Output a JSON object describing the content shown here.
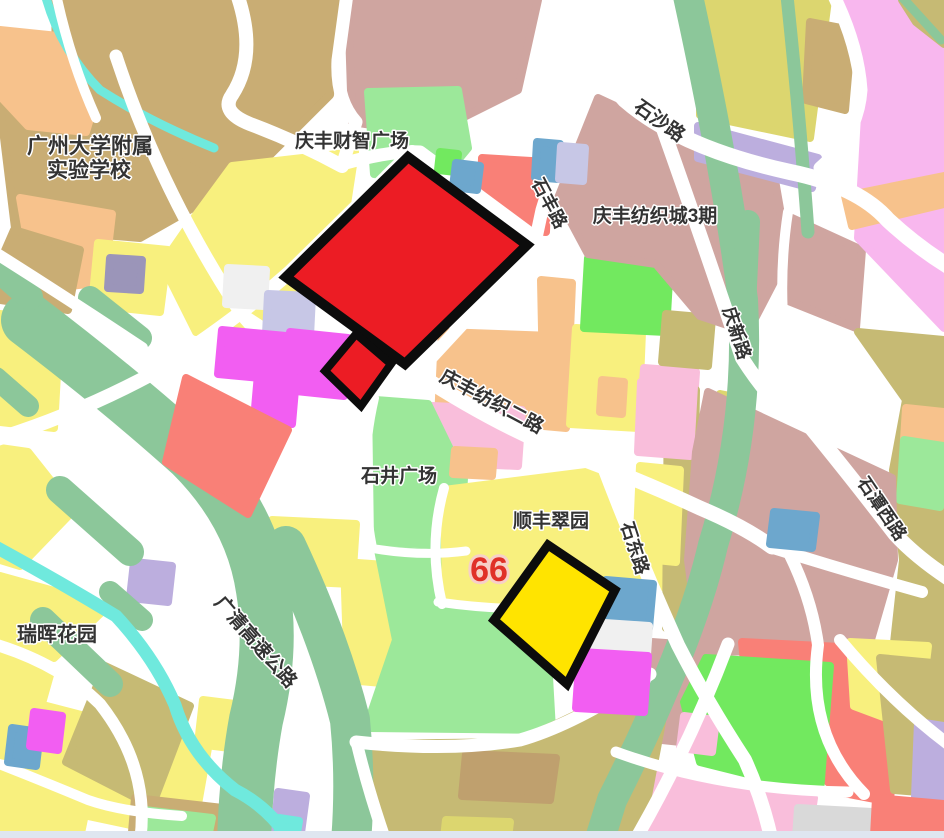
{
  "map": {
    "region_labels": {
      "school_line1": "广州大学附属",
      "school_line2": "实验学校",
      "qingfeng_caizhi_plaza": "庆丰财智广场",
      "qingfeng_textile_city_phase3": "庆丰纺织城3期",
      "shijing_plaza": "石井广场",
      "shunfeng_cuiyuan": "顺丰翠园",
      "ruihui_garden": "瑞晖花园"
    },
    "road_labels": {
      "shisha_road": "石沙路",
      "shifeng_road": "石丰路",
      "qingxin_road": "庆新路",
      "qingfeng_textile_2nd_road": "庆丰纺织二路",
      "shidong_road": "石东路",
      "shitan_west_road": "石潭西路",
      "guangqing_expressway": "广清高速公路"
    },
    "parcel_marker": {
      "number": "66"
    },
    "palette": {
      "road": "#ffffff",
      "tan": "#c9ad74",
      "khaki": "#c6ba74",
      "olive": "#dcd66f",
      "orange": "#f7c28c",
      "yellow": "#f8f07e",
      "yellow_hi": "#ffe400",
      "red": "#ec1c24",
      "outline": "#0c0c0c",
      "salmon": "#f98077",
      "rose": "#cfa5a0",
      "pink": "#f9bedb",
      "pink_big": "#f8b7ee",
      "magenta": "#f25ef2",
      "lavender": "#bcaede",
      "periwinkle": "#c7c7e6",
      "slate": "#9b95b9",
      "steel_blue": "#6da7cd",
      "sage": "#8cc79a",
      "light_green": "#9ce89a",
      "bright_green": "#72e95f",
      "cyan": "#6fe9dd",
      "gray": "#d9d9d9",
      "light_gray": "#f0f0f0",
      "brown": "#bfa06e",
      "label": "#333333",
      "marker": "#e03028",
      "marker_glow": "#f7d0c8",
      "bottom_strip": "#dfe6f0"
    }
  }
}
